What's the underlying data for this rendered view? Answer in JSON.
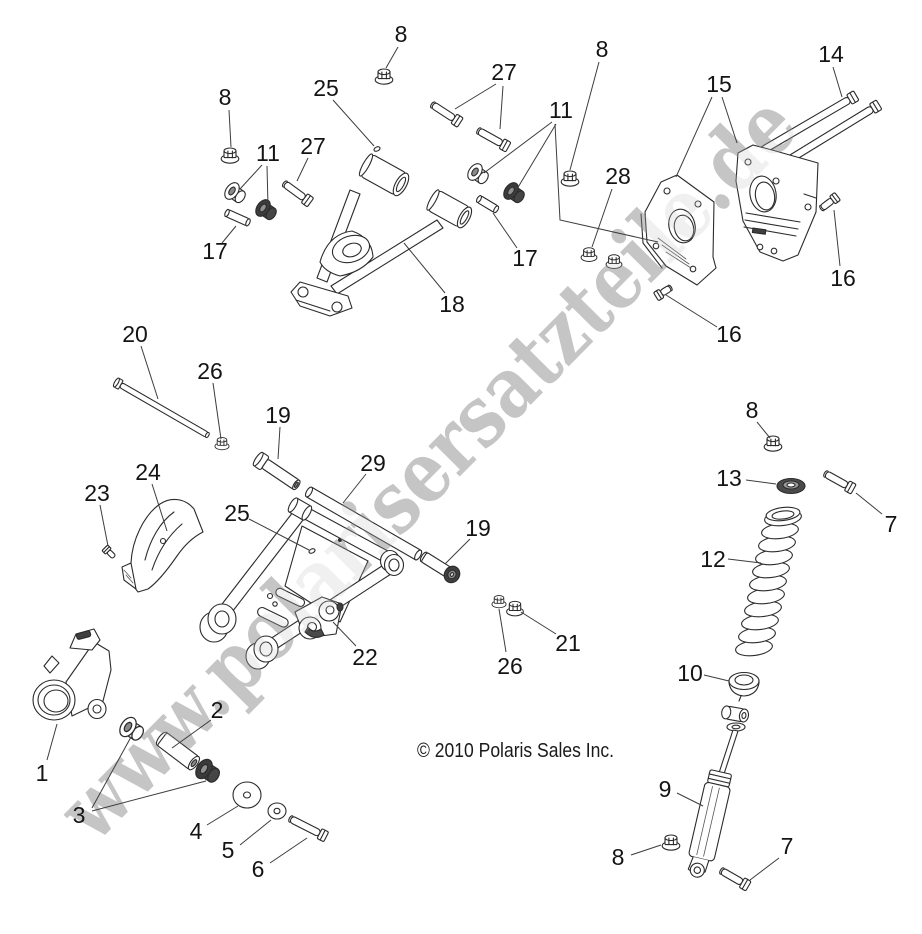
{
  "watermark": "www.polarisersatzteile.de",
  "copyright": "© 2010 Polaris Sales Inc.",
  "colors": {
    "line": "#2b2b2b",
    "label": "#141414",
    "leader": "#3d3d3d",
    "watermark": "#c6c6c6",
    "background": "#ffffff"
  },
  "callouts": [
    {
      "label": "8",
      "x": 225,
      "y": 97,
      "leaders": [
        [
          [
            229,
            110
          ],
          [
            231,
            147
          ]
        ]
      ]
    },
    {
      "label": "25",
      "x": 326,
      "y": 88,
      "leaders": [
        [
          [
            333,
            100
          ],
          [
            374,
            146
          ]
        ]
      ]
    },
    {
      "label": "8",
      "x": 401,
      "y": 34,
      "leaders": [
        [
          [
            398,
            47
          ],
          [
            386,
            68
          ]
        ]
      ]
    },
    {
      "label": "27",
      "x": 504,
      "y": 72,
      "leaders": [
        [
          [
            496,
            84
          ],
          [
            455,
            109
          ]
        ],
        [
          [
            503,
            86
          ],
          [
            500,
            129
          ]
        ]
      ]
    },
    {
      "label": "11",
      "x": 561,
      "y": 110,
      "leaders": [
        [
          [
            552,
            122
          ],
          [
            484,
            173
          ]
        ],
        [
          [
            556,
            124
          ],
          [
            517,
            189
          ]
        ],
        [
          [
            555,
            124
          ],
          [
            560,
            220
          ],
          [
            658,
            242
          ]
        ]
      ]
    },
    {
      "label": "8",
      "x": 602,
      "y": 49,
      "leaders": [
        [
          [
            599,
            62
          ],
          [
            570,
            170
          ]
        ]
      ]
    },
    {
      "label": "15",
      "x": 719,
      "y": 84,
      "leaders": [
        [
          [
            712,
            97
          ],
          [
            676,
            177
          ]
        ],
        [
          [
            722,
            97
          ],
          [
            737,
            143
          ]
        ]
      ]
    },
    {
      "label": "14",
      "x": 831,
      "y": 54,
      "leaders": [
        [
          [
            833,
            67
          ],
          [
            842,
            97
          ]
        ]
      ]
    },
    {
      "label": "28",
      "x": 618,
      "y": 176,
      "leaders": [
        [
          [
            612,
            189
          ],
          [
            592,
            247
          ]
        ]
      ]
    },
    {
      "label": "16",
      "x": 843,
      "y": 278,
      "leaders": [
        [
          [
            840,
            266
          ],
          [
            834,
            210
          ]
        ]
      ]
    },
    {
      "label": "16",
      "x": 729,
      "y": 334,
      "leaders": [
        [
          [
            717,
            327
          ],
          [
            666,
            295
          ]
        ]
      ]
    },
    {
      "label": "27",
      "x": 313,
      "y": 146,
      "leaders": [
        [
          [
            308,
            158
          ],
          [
            297,
            181
          ]
        ]
      ]
    },
    {
      "label": "11",
      "x": 268,
      "y": 153,
      "leaders": [
        [
          [
            262,
            165
          ],
          [
            240,
            189
          ]
        ],
        [
          [
            267,
            166
          ],
          [
            268,
            206
          ]
        ]
      ]
    },
    {
      "label": "17",
      "x": 215,
      "y": 251,
      "leaders": [
        [
          [
            222,
            243
          ],
          [
            236,
            226
          ]
        ]
      ]
    },
    {
      "label": "17",
      "x": 525,
      "y": 258,
      "leaders": [
        [
          [
            517,
            248
          ],
          [
            493,
            213
          ]
        ]
      ]
    },
    {
      "label": "18",
      "x": 452,
      "y": 304,
      "leaders": [
        [
          [
            445,
            293
          ],
          [
            404,
            243
          ]
        ]
      ]
    },
    {
      "label": "20",
      "x": 135,
      "y": 334,
      "leaders": [
        [
          [
            141,
            346
          ],
          [
            158,
            399
          ]
        ]
      ]
    },
    {
      "label": "26",
      "x": 210,
      "y": 371,
      "leaders": [
        [
          [
            213,
            383
          ],
          [
            221,
            439
          ]
        ]
      ]
    },
    {
      "label": "19",
      "x": 278,
      "y": 415,
      "leaders": [
        [
          [
            280,
            427
          ],
          [
            278,
            459
          ]
        ]
      ]
    },
    {
      "label": "29",
      "x": 373,
      "y": 463,
      "leaders": [
        [
          [
            366,
            474
          ],
          [
            343,
            503
          ]
        ]
      ]
    },
    {
      "label": "19",
      "x": 478,
      "y": 528,
      "leaders": [
        [
          [
            470,
            539
          ],
          [
            445,
            564
          ]
        ]
      ]
    },
    {
      "label": "25",
      "x": 237,
      "y": 513,
      "leaders": [
        [
          [
            249,
            519
          ],
          [
            309,
            550
          ]
        ]
      ]
    },
    {
      "label": "24",
      "x": 148,
      "y": 472,
      "leaders": [
        [
          [
            152,
            484
          ],
          [
            167,
            531
          ]
        ]
      ]
    },
    {
      "label": "23",
      "x": 97,
      "y": 493,
      "leaders": [
        [
          [
            100,
            505
          ],
          [
            108,
            546
          ]
        ]
      ]
    },
    {
      "label": "22",
      "x": 365,
      "y": 657,
      "leaders": [
        [
          [
            356,
            646
          ],
          [
            333,
            622
          ]
        ]
      ]
    },
    {
      "label": "21",
      "x": 568,
      "y": 643,
      "leaders": [
        [
          [
            556,
            634
          ],
          [
            521,
            612
          ]
        ]
      ]
    },
    {
      "label": "26",
      "x": 510,
      "y": 666,
      "leaders": [
        [
          [
            506,
            652
          ],
          [
            499,
            609
          ]
        ]
      ]
    },
    {
      "label": "2",
      "x": 217,
      "y": 710,
      "leaders": [
        [
          [
            211,
            720
          ],
          [
            172,
            748
          ]
        ]
      ]
    },
    {
      "label": "1",
      "x": 42,
      "y": 773,
      "leaders": [
        [
          [
            47,
            760
          ],
          [
            57,
            724
          ]
        ]
      ]
    },
    {
      "label": "3",
      "x": 79,
      "y": 815,
      "leaders": [
        [
          [
            92,
            808
          ],
          [
            131,
            737
          ]
        ],
        [
          [
            92,
            811
          ],
          [
            206,
            781
          ]
        ]
      ]
    },
    {
      "label": "4",
      "x": 196,
      "y": 831,
      "leaders": [
        [
          [
            207,
            825
          ],
          [
            238,
            806
          ]
        ]
      ]
    },
    {
      "label": "5",
      "x": 228,
      "y": 850,
      "leaders": [
        [
          [
            240,
            845
          ],
          [
            271,
            820
          ]
        ]
      ]
    },
    {
      "label": "6",
      "x": 258,
      "y": 869,
      "leaders": [
        [
          [
            270,
            863
          ],
          [
            307,
            838
          ]
        ]
      ]
    },
    {
      "label": "8",
      "x": 752,
      "y": 410,
      "leaders": [
        [
          [
            757,
            422
          ],
          [
            770,
            438
          ]
        ]
      ]
    },
    {
      "label": "13",
      "x": 729,
      "y": 478,
      "leaders": [
        [
          [
            746,
            480
          ],
          [
            776,
            484
          ]
        ]
      ]
    },
    {
      "label": "7",
      "x": 891,
      "y": 524,
      "leaders": [
        [
          [
            882,
            514
          ],
          [
            856,
            493
          ]
        ]
      ]
    },
    {
      "label": "12",
      "x": 713,
      "y": 559,
      "leaders": [
        [
          [
            728,
            559
          ],
          [
            761,
            563
          ]
        ]
      ]
    },
    {
      "label": "10",
      "x": 690,
      "y": 673,
      "leaders": [
        [
          [
            704,
            675
          ],
          [
            729,
            681
          ]
        ]
      ]
    },
    {
      "label": "9",
      "x": 665,
      "y": 789,
      "leaders": [
        [
          [
            677,
            793
          ],
          [
            703,
            806
          ]
        ]
      ]
    },
    {
      "label": "8",
      "x": 618,
      "y": 857,
      "leaders": [
        [
          [
            631,
            855
          ],
          [
            661,
            845
          ]
        ]
      ]
    },
    {
      "label": "7",
      "x": 787,
      "y": 846,
      "leaders": [
        [
          [
            779,
            858
          ],
          [
            750,
            880
          ]
        ]
      ]
    }
  ]
}
